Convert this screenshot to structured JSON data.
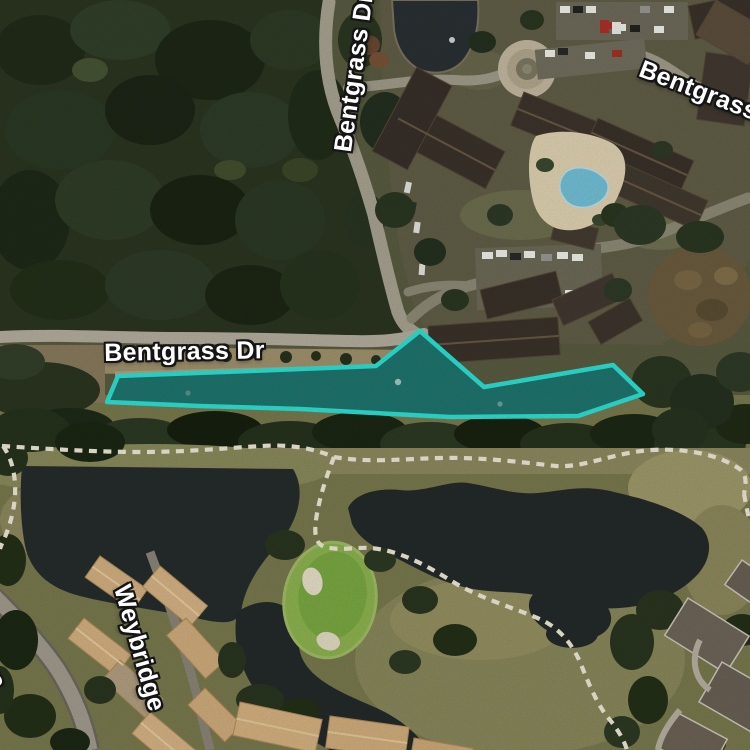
{
  "map": {
    "kind": "satellite-aerial-map",
    "labels": [
      {
        "text": "Bentgrass Dr",
        "x": 330,
        "y": 150,
        "rotation": -82
      },
      {
        "text": "Bentgrass",
        "x": 645,
        "y": 56,
        "rotation": 21
      },
      {
        "text": "Bentgrass Dr",
        "x": 104,
        "y": 340,
        "rotation": -1
      },
      {
        "text": "Weybridge",
        "x": 134,
        "y": 582,
        "rotation": 74
      },
      {
        "text": "Ave",
        "x": -6,
        "y": 640,
        "rotation": 68
      }
    ]
  },
  "parcel": {
    "label": "highlighted waterbody parcel",
    "points": "107,402 118,376 250,371 376,366 420,331 484,387 613,365 643,394 578,416 450,417 300,409 200,406",
    "fill": "#22d8cc",
    "fill_opacity": "0.42",
    "stroke": "#2de4d6",
    "stroke_width": "4.5"
  },
  "palette": {
    "highlight_teal": "#2de4d6",
    "water_dark": "#262d2c",
    "cart_path_white": "#f1ebd8",
    "label_halo": "#151515"
  }
}
